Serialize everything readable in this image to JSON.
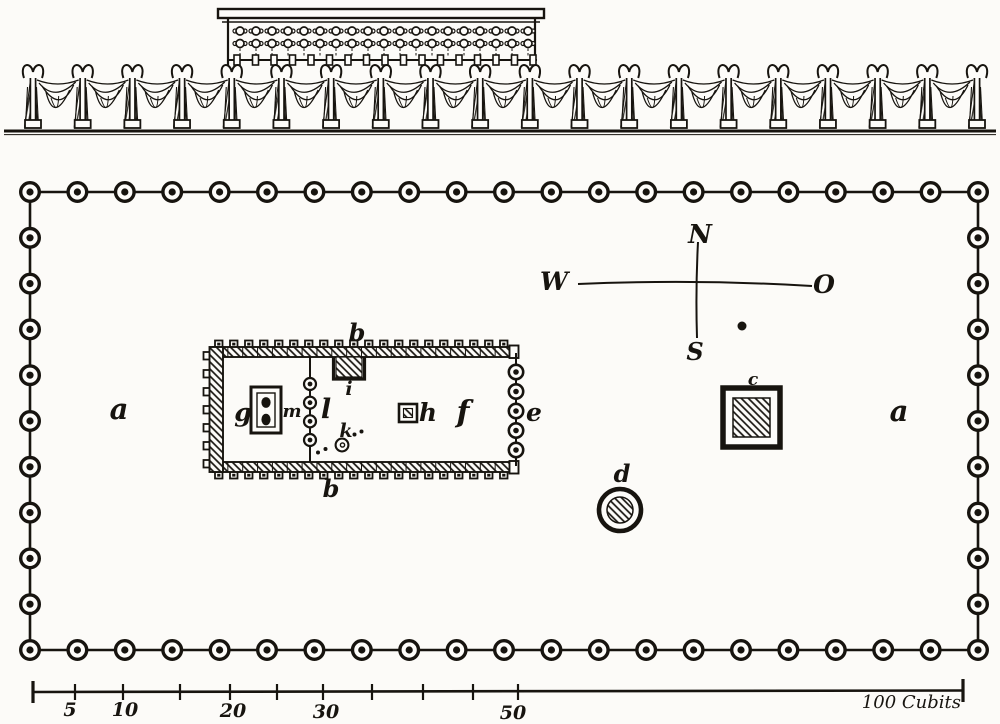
{
  "compass": {
    "north": "N",
    "west": "W",
    "east": "O",
    "south": "S"
  },
  "plan_labels": {
    "court_left": "a",
    "court_right": "a",
    "building_top": "b",
    "building_bottom": "b",
    "square_altar": "c",
    "round_laver": "d",
    "east_pillar_row": "e",
    "hall_east": "f",
    "hall_west": "g",
    "small_square": "h",
    "recess_top": "i",
    "dotted_circle": "k",
    "middle_pillar_row": "l",
    "inner_chest": "m"
  },
  "scale_bar": {
    "tick_labels": [
      "5",
      "10",
      "20",
      "30",
      "50"
    ],
    "end_label": "100 Cubits"
  },
  "counts": {
    "court_pillars_long_side": 21,
    "court_pillars_short_side": 11,
    "elevation_pillars": 20,
    "east_entrance_pillars": 5,
    "veil_pillars": 4,
    "board_knobs_long_side": 20,
    "board_knobs_west_side": 7,
    "loop_rows": 2,
    "loops_per_row": 19,
    "rod_beads": 17
  }
}
